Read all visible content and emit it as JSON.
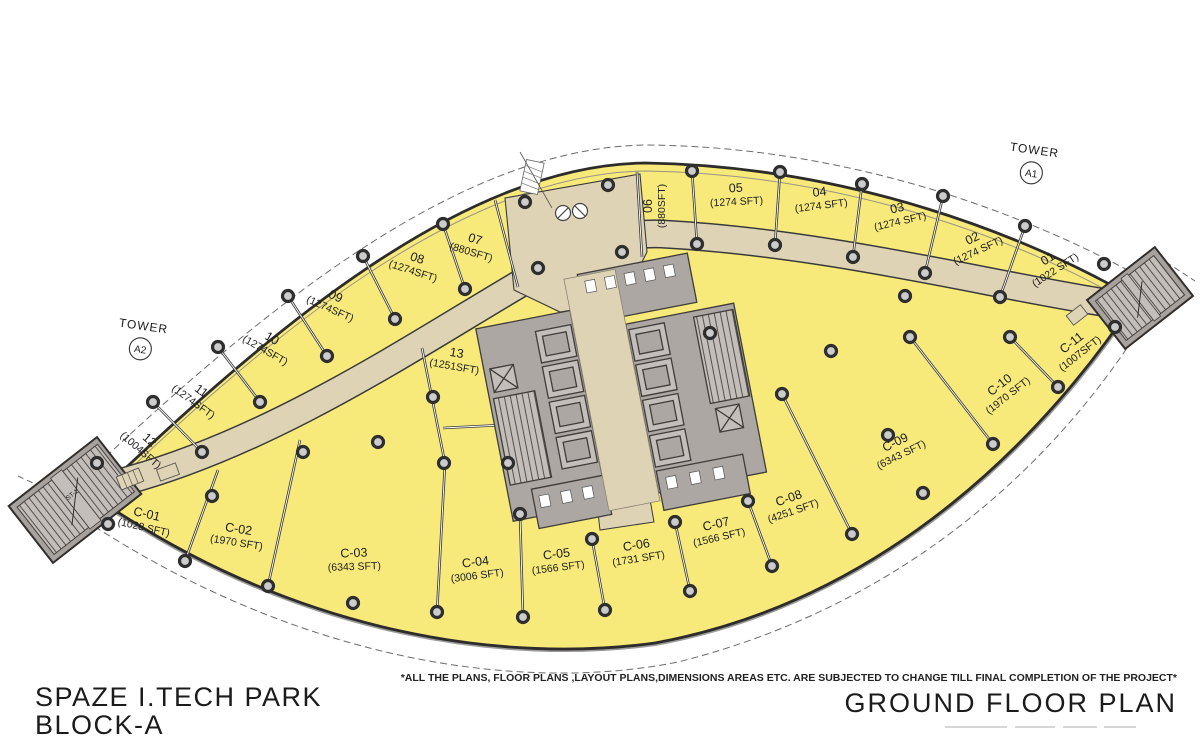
{
  "plan": {
    "project_title": "SPAZE I.TECH PARK",
    "block": "BLOCK-A",
    "plan_title": "GROUND FLOOR PLAN",
    "disclaimer": "*ALL THE PLANS, FLOOR PLANS ,LAYOUT PLANS,DIMENSIONS AREAS ETC. ARE SUBJECTED TO CHANGE TILL FINAL COMPLETION OF THE PROJECT*",
    "towers": {
      "a1": {
        "label": "TOWER",
        "code": "A1"
      },
      "a2": {
        "label": "TOWER",
        "code": "A2"
      }
    },
    "stair_label": "ST-1",
    "colors": {
      "unit_fill": "#F7EA7B",
      "corridor_fill": "#DFD3B5",
      "core_fill": "#ACA7A3",
      "outline": "#2E2C2A",
      "column_ring": "#2E2E2E"
    },
    "upper_units": [
      {
        "id": "01",
        "area": "(1022 SFT)"
      },
      {
        "id": "02",
        "area": "(1274 SFT)"
      },
      {
        "id": "03",
        "area": "(1274 SFT)"
      },
      {
        "id": "04",
        "area": "(1274 SFT)"
      },
      {
        "id": "05",
        "area": "(1274 SFT)"
      },
      {
        "id": "06",
        "area": "(880SFT)"
      },
      {
        "id": "07",
        "area": "(880SFT)"
      },
      {
        "id": "08",
        "area": "(1274SFT)"
      },
      {
        "id": "09",
        "area": "(1274SFT)"
      },
      {
        "id": "10",
        "area": "(1274SFT)"
      },
      {
        "id": "11",
        "area": "(1274SFT)"
      },
      {
        "id": "12",
        "area": "(1004SFT)"
      },
      {
        "id": "13",
        "area": "(1251SFT)"
      }
    ],
    "lower_units": [
      {
        "id": "C-01",
        "area": "(1028 SFT)"
      },
      {
        "id": "C-02",
        "area": "(1970 SFT)"
      },
      {
        "id": "C-03",
        "area": "(6343 SFT)"
      },
      {
        "id": "C-04",
        "area": "(3006 SFT)"
      },
      {
        "id": "C-05",
        "area": "(1566 SFT)"
      },
      {
        "id": "C-06",
        "area": "(1731 SFT)"
      },
      {
        "id": "C-07",
        "area": "(1566 SFT)"
      },
      {
        "id": "C-08",
        "area": "(4251 SFT)"
      },
      {
        "id": "C-09",
        "area": "(6343 SFT)"
      },
      {
        "id": "C-10",
        "area": "(1970 SFT)"
      },
      {
        "id": "C-11",
        "area": "(1007SFT)"
      }
    ]
  }
}
